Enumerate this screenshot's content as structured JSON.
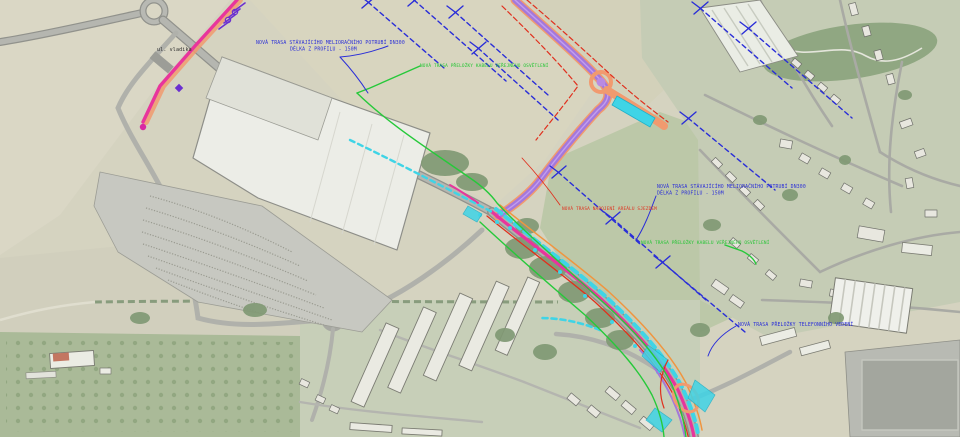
{
  "map": {
    "kind": "aerial-site-plan-with-utility-overlay",
    "annotations": [
      {
        "id": "melioration-note-west",
        "color": "blue",
        "line1": "NOVÁ TRASA STÁVAJÍCÍHO MELIORAČNÍHO POTRUBÍ DN300",
        "line2": "DÉLKA Z PROFILU - 150M"
      },
      {
        "id": "lighting-note-west",
        "color": "green",
        "line1": "NOVÁ TRASA PŘELOŽKY KABELU VEŘEJNÉHO OSVĚTLENÍ"
      },
      {
        "id": "melioration-note-east",
        "color": "blue",
        "line1": "NOVÁ TRASA STÁVAJÍCÍHO MELIORAČNÍHO POTRUBÍ DN300",
        "line2": "DÉLKA Z PROFILU - 150M"
      },
      {
        "id": "lighting-note-east",
        "color": "green",
        "line1": "NOVÁ TRASA PŘELOŽKY KABELU VEŘEJNÉHO OSVĚTLENÍ"
      },
      {
        "id": "access-note",
        "color": "red",
        "line1": "NOVÁ TRASA NAPOJENÍ AREÁLU SJEZDEM"
      },
      {
        "id": "telecom-note",
        "color": "blue",
        "line1": "NOVÁ TRASA PŘELOŽKY TELEFONNÍHO VEDENÍ"
      },
      {
        "id": "street-label",
        "color": "black",
        "line1": "ul. vladika"
      }
    ],
    "colors": {
      "annotation_blue": "#2a2ed8",
      "annotation_green": "#22c532",
      "annotation_red": "#e0301e",
      "annotation_black": "#2b2b2b",
      "water_main_pink": "#e8359c",
      "casing_salmon": "#f19a6f",
      "new_road_purple": "#a478da",
      "cyan_utility": "#3fd4e6",
      "green_utility": "#26c93a",
      "red_utility": "#e0301e",
      "orange_utility": "#f0953f",
      "drainage_blue": "#2a2ed8",
      "hatch_purple": "#6b2fd0"
    }
  }
}
